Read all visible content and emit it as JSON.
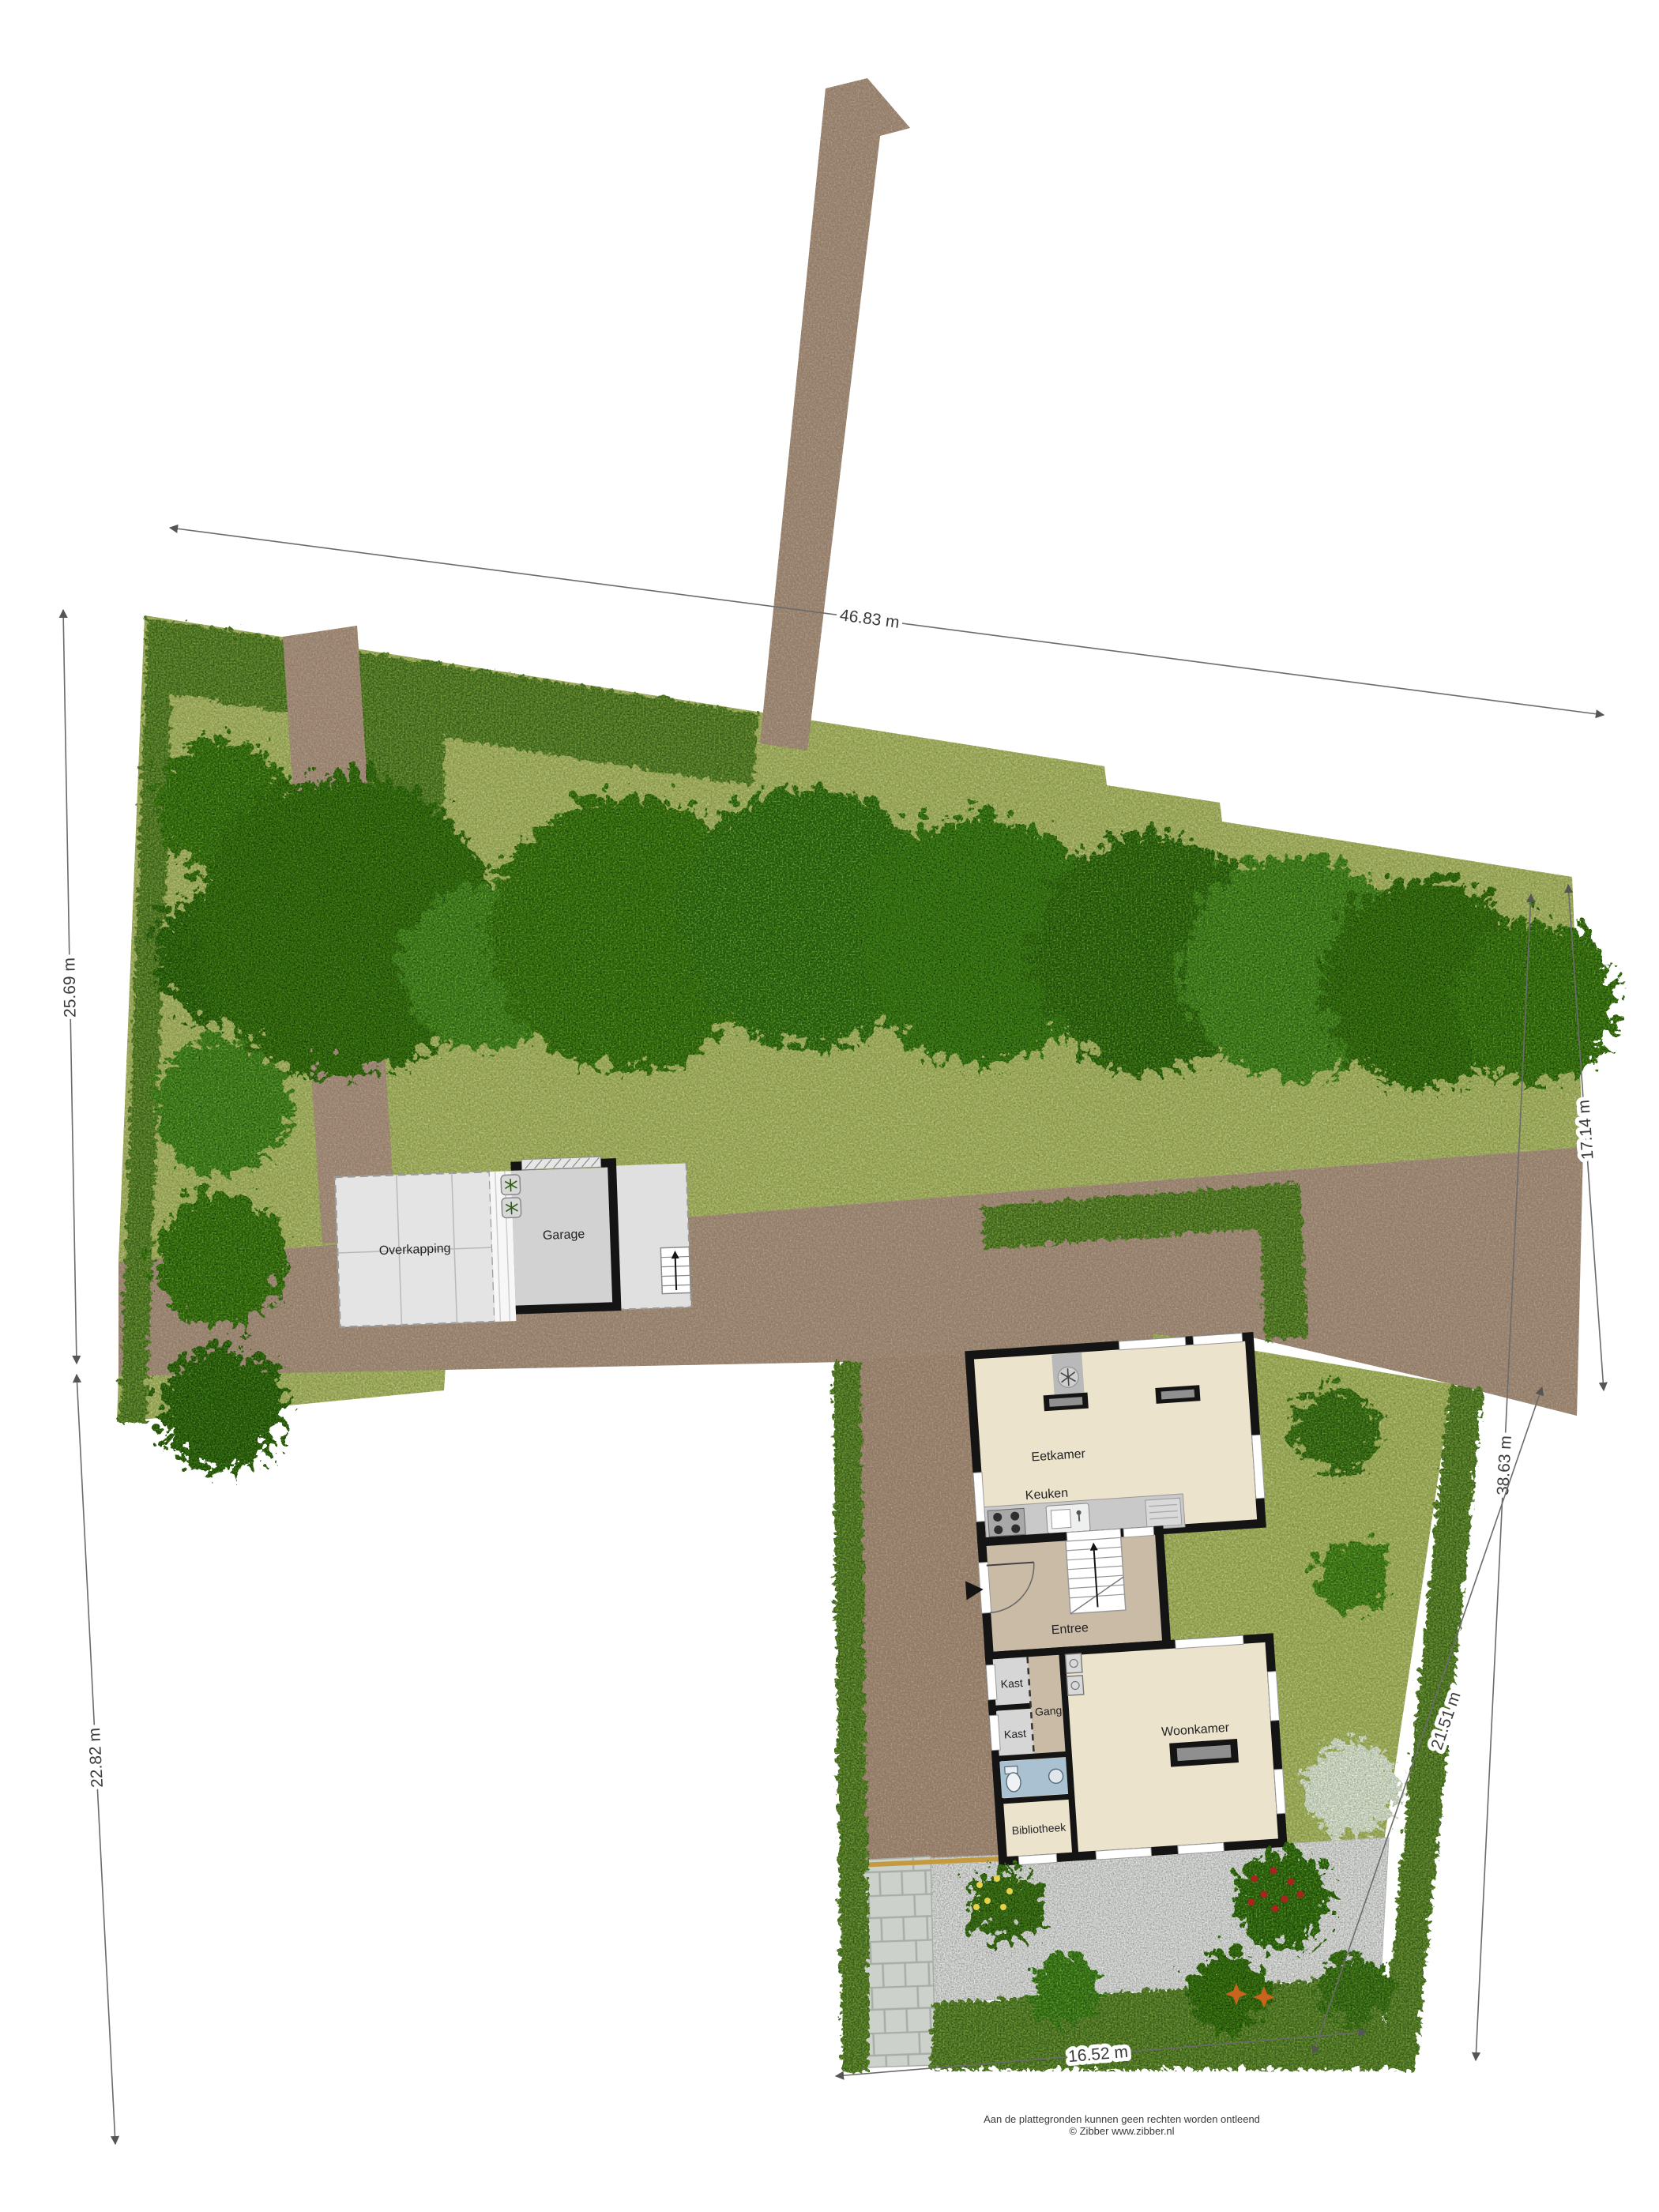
{
  "plan": {
    "title": "Plattegrond tuin / begane grond",
    "rooms": {
      "overkapping": "Overkapping",
      "garage": "Garage",
      "eetkamer": "Eetkamer",
      "keuken": "Keuken",
      "entree": "Entree",
      "kast1": "Kast",
      "kast2": "Kast",
      "gang": "Gang",
      "woonkamer": "Woonkamer",
      "bibliotheek": "Bibliotheek"
    },
    "dimensions": {
      "top": "46.83 m",
      "left_upper": "25.69 m",
      "left_lower": "22.82 m",
      "right_outer": "17.14 m",
      "right_long": "38.63 m",
      "right_inner": "21.51 m",
      "bottom": "16.52 m"
    },
    "footer": {
      "line1": "Aan de plattegronden kunnen geen rechten worden ontleend",
      "line2": "© Zibber www.zibber.nl"
    },
    "colors": {
      "grass": "#a2ad5e",
      "hedge": "#4c7427",
      "tree": "#377119",
      "driveway": "#9c8773",
      "house_floor": "#ebe3cc",
      "hall_floor": "#c9bba6",
      "closet_floor": "#d6d6d6",
      "toilet_floor": "#a9c1d1",
      "garage_floor": "#d2d2d2",
      "carport_floor": "#e4e4e4",
      "gravel": "#eceae6",
      "wall": "#141414",
      "accent_line": "#c49a3e"
    }
  }
}
